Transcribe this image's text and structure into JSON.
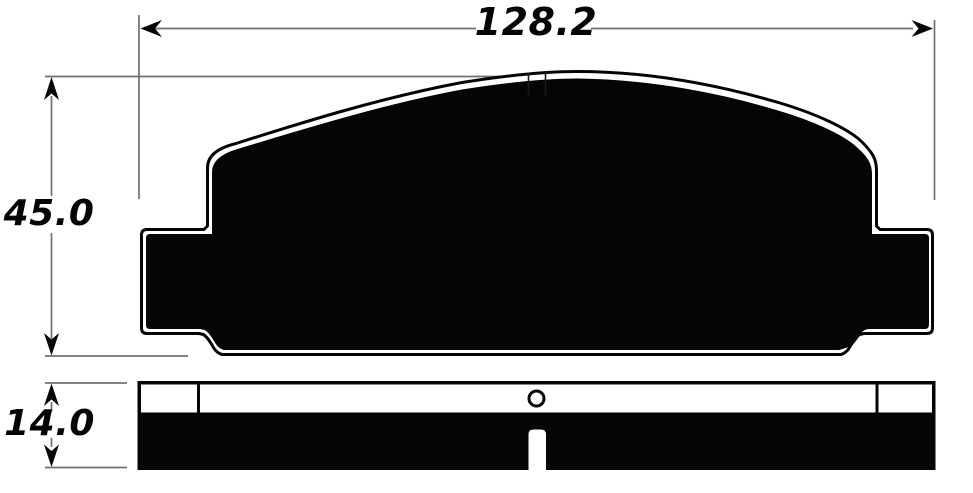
{
  "drawing": {
    "dimensions": {
      "width": {
        "value": "128.2"
      },
      "height": {
        "value": "45.0"
      },
      "thickness": {
        "value": "14.0"
      }
    },
    "colors": {
      "background": "#ffffff",
      "ink": "#000000",
      "dimension_line": "#707070"
    }
  }
}
